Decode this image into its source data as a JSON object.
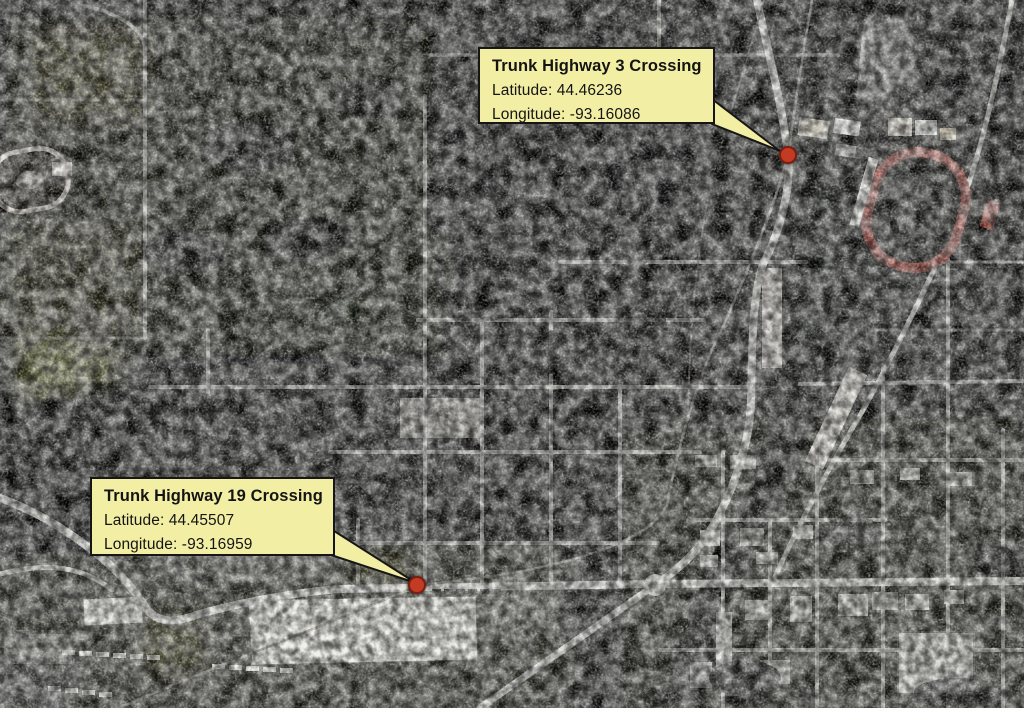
{
  "crossings": [
    {
      "title": "Trunk Highway 3 Crossing",
      "latitude_line": "Latitude: 44.46236",
      "longitude_line": "Longitude: -93.16086",
      "marker_icon": "red-dot-marker",
      "marker_color": "#C43B24"
    },
    {
      "title": "Trunk Highway 19 Crossing",
      "latitude_line": "Latitude: 44.45507",
      "longitude_line": "Longitude: -93.16959",
      "marker_icon": "red-dot-marker",
      "marker_color": "#C43B24"
    }
  ],
  "colors": {
    "callout_background": "#F2EEA4",
    "callout_border": "#161616",
    "callout_text": "#141414",
    "marker_fill": "#C43B24",
    "marker_border": "#7C1D12",
    "road": "#C9C9C3",
    "water_corridor": "#050704"
  }
}
